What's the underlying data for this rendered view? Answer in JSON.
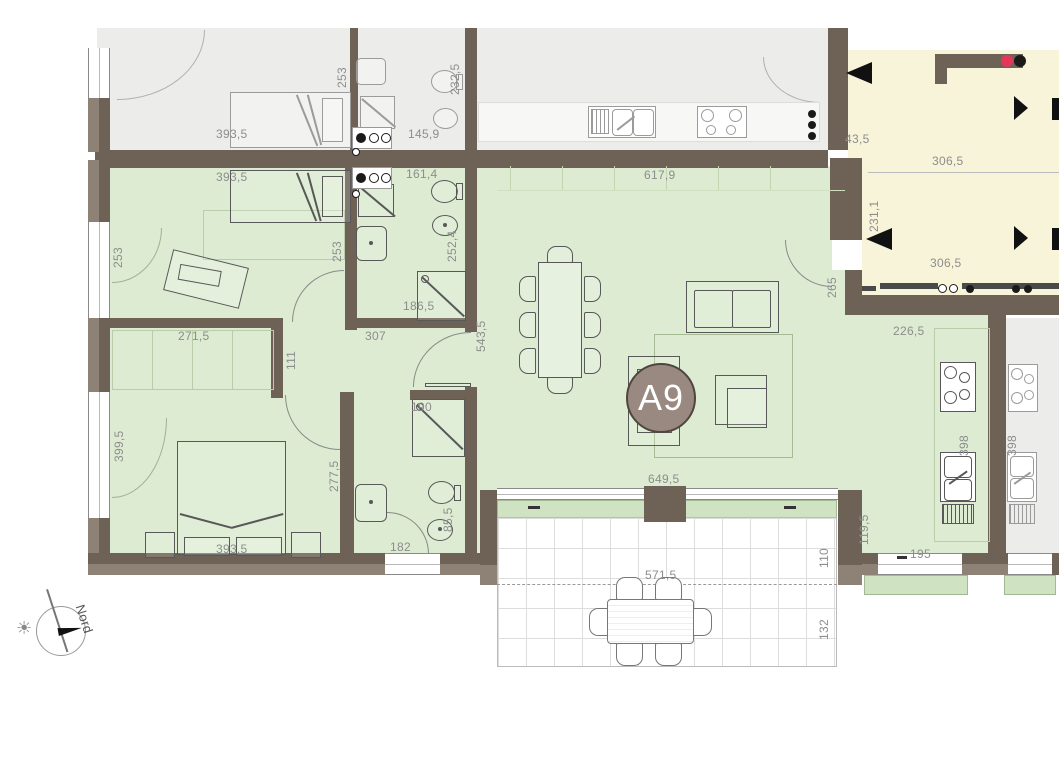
{
  "plan": {
    "unit_badge": "A9",
    "compass_north": "Nord"
  },
  "colors": {
    "wall": "#6e6156",
    "wall_outer": "#8e8276",
    "apartment_fill": "#dcebd1",
    "neighbor_fill": "#ececeb",
    "stairwell_fill": "#f8f4da",
    "badge_fill": "#9a8981",
    "stair_mark_red": "#e5365a"
  },
  "dims": {
    "neighbor_top": {
      "bed_width": "393,5",
      "bed_depth": "253",
      "bath_width": "145,9",
      "bath_depth": "232,5"
    },
    "stairwell": {
      "gap": "43,5",
      "upper_width": "306,5",
      "depth": "231,1",
      "lower_width": "306,5"
    },
    "apartment": {
      "living_width": "617,9",
      "living_pass": "265",
      "bed1_width": "393,5",
      "bed1_side_left": "253",
      "bed1_side_right": "253",
      "bath1_width": "161,4",
      "bath1_depth": "252,4",
      "bath1_shower": "186,5",
      "hall_wall": "271,5",
      "hall_jog": "111",
      "hall_width": "307",
      "dining_depth": "543,5",
      "bed3_window": "399,5",
      "bed3_wall": "277,5",
      "bed3_width": "393,5",
      "bath2_width": "190",
      "bath2_side": "85,5",
      "bath2_door": "182",
      "patio_door": "649,5",
      "kitchen_width": "226,5",
      "kitchen_counter": "398",
      "kitchen_pass": "119,5",
      "kitchen_window": "195"
    },
    "neighbor_right": {
      "counter": "398"
    },
    "terrace": {
      "width": "571,5",
      "near": "110",
      "far": "132"
    }
  }
}
